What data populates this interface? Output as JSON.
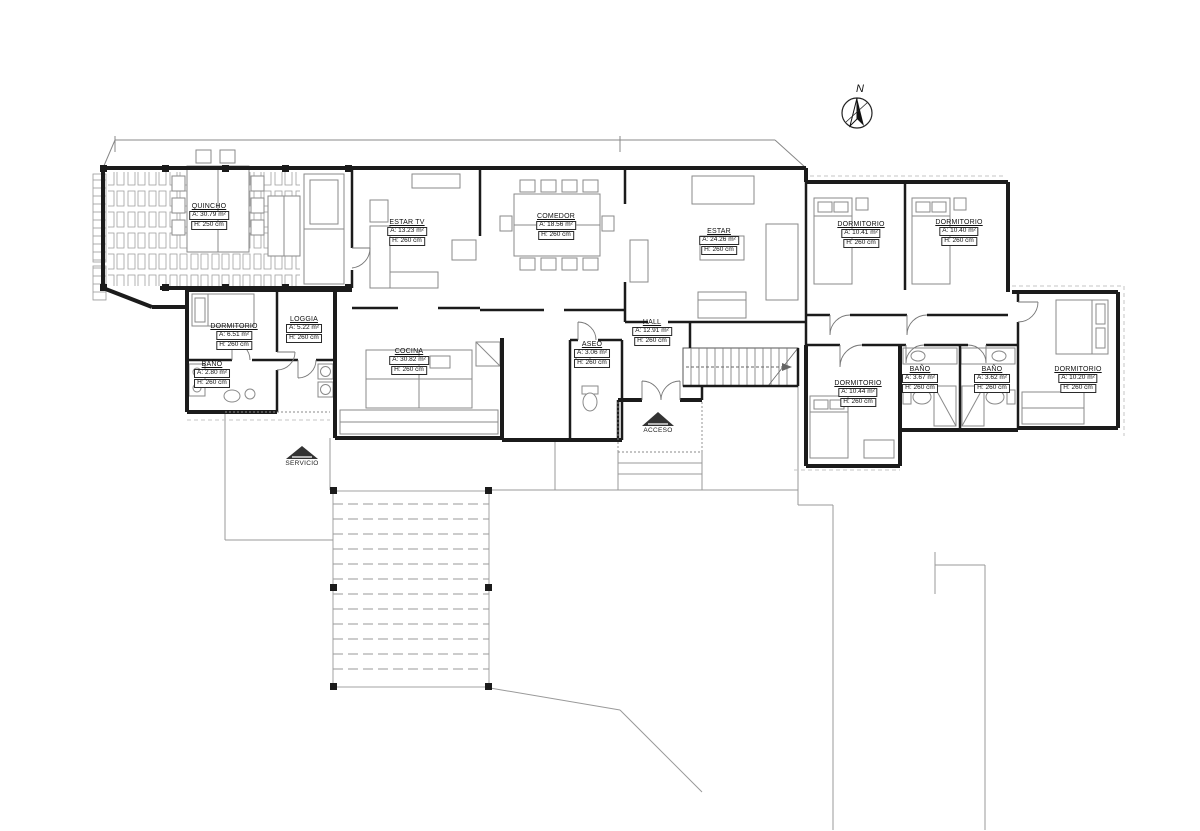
{
  "drawing": {
    "type": "architectural-floor-plan",
    "background_color": "#ffffff",
    "wall_color": "#1b1b1b",
    "furniture_color": "#8a8a8a",
    "terrain_color": "#999999"
  },
  "compass": {
    "label": "N"
  },
  "arrows": [
    {
      "label": "SERVICIO"
    },
    {
      "label": "ACCESO"
    }
  ],
  "rooms": [
    {
      "name": "QUINCHO",
      "area": "A: 30.79 m²",
      "height": "H: 250 cm"
    },
    {
      "name": "ESTAR TV",
      "area": "A: 13.23 m²",
      "height": "H: 260 cm"
    },
    {
      "name": "COMEDOR",
      "area": "A: 18.56 m²",
      "height": "H: 260 cm"
    },
    {
      "name": "ESTAR",
      "area": "A: 24.26 m²",
      "height": "H: 260 cm"
    },
    {
      "name": "DORMITORIO",
      "area": "A: 10.41 m²",
      "height": "H: 260 cm"
    },
    {
      "name": "DORMITORIO",
      "area": "A: 10.40 m²",
      "height": "H: 260 cm"
    },
    {
      "name": "DORMITORIO",
      "area": "A: 6.51 m²",
      "height": "H: 260 cm"
    },
    {
      "name": "LOGGIA",
      "area": "A: 5.22 m²",
      "height": "H: 260 cm"
    },
    {
      "name": "BAÑO",
      "area": "A: 2.80 m²",
      "height": "H: 260 cm"
    },
    {
      "name": "COCINA",
      "area": "A: 30.82 m²",
      "height": "H: 260 cm"
    },
    {
      "name": "ASEO",
      "area": "A: 3.06 m²",
      "height": "H: 260 cm"
    },
    {
      "name": "HALL",
      "area": "A: 12.91 m²",
      "height": "H: 260 cm"
    },
    {
      "name": "DORMITORIO",
      "area": "A: 10.44 m²",
      "height": "H: 260 cm"
    },
    {
      "name": "BAÑO",
      "area": "A: 3.67 m²",
      "height": "H: 260 cm"
    },
    {
      "name": "BAÑO",
      "area": "A: 3.62 m²",
      "height": "H: 260 cm"
    },
    {
      "name": "DORMITORIO",
      "area": "A: 10.20 m²",
      "height": "H: 260 cm"
    }
  ]
}
